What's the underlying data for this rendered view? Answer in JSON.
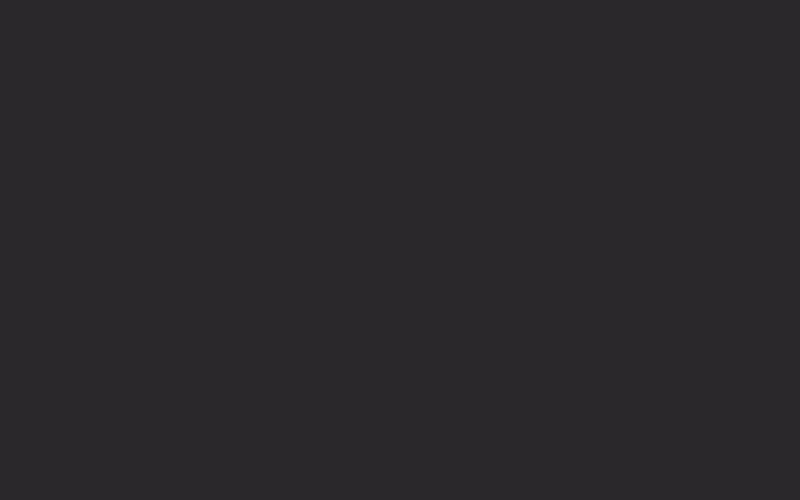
{
  "meta": {
    "type": "architectural-section-drawing",
    "width": 800,
    "height": 500
  },
  "palette": {
    "bg": "#2a282b",
    "bg_dark": "#191719",
    "interior": "#232124",
    "line": "#f4f4f4",
    "line_dim": "#d9d9d9",
    "line_faint": "#b5b5b5",
    "figure": "#f2f2f2",
    "ground": "#59585b",
    "ground_edge": "#6a696c",
    "tree_top": "#343336",
    "tree_mid": "#4b4a4e",
    "tree_light": "#5c5b5f",
    "tree_bottom": "#4a494b",
    "tree_dark": "#2b292c",
    "branch": "#6f6e71"
  },
  "mottle": [
    {
      "cx": 100,
      "cy": 80,
      "r": 130
    },
    {
      "cx": 70,
      "cy": 300,
      "r": 110
    },
    {
      "cx": 420,
      "cy": 240,
      "r": 170
    },
    {
      "cx": 300,
      "cy": 430,
      "r": 140
    },
    {
      "cx": 620,
      "cy": 60,
      "r": 120
    }
  ],
  "ground_block": {
    "x": 0,
    "y": 439,
    "w": 152,
    "h": 61
  },
  "tree": {
    "blobs": [
      {
        "pts": "800,204 760,212 742,198 722,212 698,202 688,222 664,216 676,242 656,250 670,272 650,282 664,302 648,318 662,338 646,354 660,374 648,394 800,398",
        "fill": "tree_mid"
      },
      {
        "pts": "648,388 662,400 650,416 664,432 650,448 662,464 648,480 658,500 800,500 800,384 756,394 724,382 696,398 670,386",
        "fill": "tree_bottom"
      },
      {
        "pts": "726,252 770,240 800,252 800,330 756,344 718,330 700,300 712,272",
        "fill": "tree_light"
      },
      {
        "pts": "664,408 706,396 744,410 752,448 724,478 678,470 654,440",
        "fill": "tree_light"
      },
      {
        "pts": "680,246 700,236 716,252 700,264",
        "fill": "tree_light"
      },
      {
        "pts": "800,30 742,38 716,54 726,72 698,66 706,92 680,90 692,114 670,118 684,142 662,146 676,170 656,172 668,194 652,200 664,220 650,232 800,238",
        "fill": "tree_top"
      },
      {
        "pts": "748,140 800,120 800,200 756,196 736,168",
        "fill": "tree_dark"
      },
      {
        "pts": "690,444 722,436 730,472 700,488",
        "fill": "tree_dark"
      },
      {
        "pts": "660,330 684,318 694,344 668,356",
        "fill": "tree_dark"
      }
    ],
    "branches": [
      [
        712,
        500,
        694,
        386
      ],
      [
        718,
        500,
        734,
        372
      ],
      [
        700,
        474,
        666,
        404
      ],
      [
        742,
        462,
        776,
        384
      ],
      [
        726,
        434,
        758,
        352
      ],
      [
        688,
        500,
        676,
        442
      ],
      [
        734,
        410,
        716,
        348
      ],
      [
        752,
        430,
        792,
        400
      ]
    ]
  },
  "structure": {
    "interior": {
      "x": 152,
      "y": 10,
      "w": 496,
      "h": 447
    },
    "slabs": [
      {
        "x": 146,
        "y": 2,
        "w": 516,
        "h": 11,
        "n": "roof-slab"
      },
      {
        "x": 327,
        "y": 78,
        "w": 335,
        "h": 12,
        "n": "terrace-slab"
      },
      {
        "x": 327,
        "y": 161,
        "w": 335,
        "h": 16,
        "n": "upper-floor-slab-right"
      },
      {
        "x": 148,
        "y": 172,
        "w": 186,
        "h": 12,
        "n": "upper-floor-slab-left"
      },
      {
        "x": 148,
        "y": 267,
        "w": 186,
        "h": 16,
        "n": "mid-floor-slab-left"
      },
      {
        "x": 480,
        "y": 263,
        "w": 182,
        "h": 16,
        "n": "mid-floor-slab-right"
      },
      {
        "x": 480,
        "y": 263,
        "w": 16,
        "h": 37,
        "n": "slab-step"
      },
      {
        "x": 148,
        "y": 345,
        "w": 427,
        "h": 18,
        "n": "lower-floor-slab"
      },
      {
        "x": 148,
        "y": 435,
        "w": 514,
        "h": 20,
        "n": "ground-slab"
      },
      {
        "x": 158,
        "y": 13,
        "w": 14,
        "h": 11,
        "n": "roof-beam-stub"
      },
      {
        "x": 325,
        "y": 13,
        "w": 14,
        "h": 11,
        "n": "roof-beam-stub"
      },
      {
        "x": 472,
        "y": 13,
        "w": 14,
        "h": 11,
        "n": "roof-beam-stub"
      },
      {
        "x": 631,
        "y": 13,
        "w": 12,
        "h": 11,
        "n": "roof-beam-stub"
      },
      {
        "x": 327,
        "y": 90,
        "w": 15,
        "h": 12,
        "n": "beam-stub"
      },
      {
        "x": 483,
        "y": 97,
        "w": 12,
        "h": 9,
        "n": "beam-stub"
      },
      {
        "x": 327,
        "y": 363,
        "w": 14,
        "h": 9,
        "n": "beam-stub"
      },
      {
        "x": 327,
        "y": 455,
        "w": 14,
        "h": 9,
        "n": "beam-stub"
      },
      {
        "x": 472,
        "y": 455,
        "w": 14,
        "h": 9,
        "n": "beam-stub"
      },
      {
        "x": 146,
        "y": 78,
        "w": 12,
        "h": 18,
        "n": "wall-pier"
      },
      {
        "x": 146,
        "y": 166,
        "w": 12,
        "h": 18,
        "n": "wall-pier"
      },
      {
        "x": 146,
        "y": 263,
        "w": 12,
        "h": 20,
        "n": "wall-pier"
      },
      {
        "x": 146,
        "y": 341,
        "w": 12,
        "h": 22,
        "n": "wall-pier"
      },
      {
        "x": 146,
        "y": 428,
        "w": 12,
        "h": 27,
        "n": "wall-pier"
      },
      {
        "x": 151,
        "y": 13,
        "w": 4,
        "h": 444,
        "n": "left-wall"
      },
      {
        "x": 646,
        "y": 8,
        "w": 8,
        "h": 449,
        "n": "right-wall"
      },
      {
        "x": 636,
        "y": 55,
        "w": 10,
        "h": 24,
        "n": "terrace-parapet"
      }
    ],
    "bands": [
      {
        "x": 345,
        "y": 90,
        "w": 293,
        "h": 8
      },
      {
        "x": 348,
        "y": 177,
        "w": 286,
        "h": 8
      },
      {
        "x": 496,
        "y": 279,
        "w": 142,
        "h": 19
      }
    ],
    "walls": [
      [
        328,
        88,
        328,
        435
      ],
      [
        334,
        88,
        334,
        435
      ],
      [
        300,
        150,
        300,
        267
      ],
      [
        255,
        150,
        300,
        150
      ],
      [
        270,
        184,
        270,
        267
      ],
      [
        477,
        184,
        477,
        263
      ],
      [
        481,
        184,
        481,
        263
      ],
      [
        575,
        298,
        575,
        435
      ],
      [
        640,
        103,
        640,
        435
      ]
    ],
    "lines": [
      [
        152,
        26,
        650,
        26
      ],
      [
        157,
        78,
        327,
        78
      ],
      [
        157,
        108,
        327,
        108
      ],
      [
        345,
        103,
        644,
        103
      ],
      [
        152,
        372,
        573,
        372
      ],
      [
        152,
        462,
        648,
        462
      ]
    ],
    "curve": "M158,186 C185,205 235,212 328,213",
    "hatch": [
      [
        165,
        190
      ],
      [
        172,
        194
      ],
      [
        181,
        198
      ],
      [
        196,
        202
      ],
      [
        224,
        206
      ],
      [
        266,
        210
      ]
    ],
    "hatch_end_x": 327,
    "grid": {
      "x1": 336,
      "x2": 477,
      "y1": 263,
      "y2": 344,
      "rows": 11,
      "v_sparse": [
        353,
        371,
        389,
        407
      ],
      "dense_x1": 423,
      "dense_step": 4.5
    },
    "ramp_curves": [
      "M400,344 Q446,341 477,322",
      "M408,344 Q450,343 477,327",
      "M416,344 Q454,345 477,332"
    ],
    "ladder": {
      "x": 255,
      "y": 297,
      "w": 9,
      "h": 48
    }
  },
  "bookshelves": [
    {
      "x": 352,
      "y": 117,
      "w": 110,
      "h": 44,
      "door": {
        "x": 415,
        "w": 22
      },
      "seed": 7
    },
    {
      "x": 500,
      "y": 217,
      "w": 92,
      "h": 45,
      "door": {
        "x": 530,
        "w": 22
      },
      "seed": 13
    }
  ],
  "furniture": [
    {
      "t": "tower",
      "x": 163,
      "y": 215
    },
    {
      "t": "tower",
      "x": 193,
      "y": 215
    },
    {
      "t": "tower",
      "x": 223,
      "y": 215
    },
    {
      "t": "desk",
      "x": 186,
      "y": 250,
      "w": 26
    },
    {
      "t": "desk",
      "x": 216,
      "y": 250,
      "w": 26
    },
    {
      "t": "desk",
      "x": 246,
      "y": 250,
      "w": 26
    },
    {
      "t": "chairL",
      "x": 170,
      "y": 345,
      "w": 18
    },
    {
      "t": "table",
      "x": 198,
      "y": 345,
      "w": 20
    },
    {
      "t": "chairR",
      "x": 224,
      "y": 345,
      "w": 18
    },
    {
      "t": "counter",
      "x": 162,
      "y": 437,
      "w": 63
    },
    {
      "t": "cabinet",
      "x": 162,
      "y": 398
    },
    {
      "t": "rod",
      "x": 189,
      "y": 400
    },
    {
      "t": "chairL",
      "x": 246,
      "y": 435,
      "w": 17
    },
    {
      "t": "table",
      "x": 271,
      "y": 435,
      "w": 21
    },
    {
      "t": "chairR",
      "x": 297,
      "y": 435,
      "w": 18
    },
    {
      "t": "chairL",
      "x": 341,
      "y": 435,
      "w": 18
    },
    {
      "t": "table",
      "x": 369,
      "y": 435,
      "w": 21
    },
    {
      "t": "sidetable",
      "x": 398,
      "y": 435,
      "w": 17
    },
    {
      "t": "xdoor",
      "x": 416,
      "y": 389,
      "w": 37,
      "h": 46
    },
    {
      "t": "box",
      "x": 624,
      "y": 66,
      "w": 14,
      "h": 12
    },
    {
      "t": "box",
      "x": 618,
      "y": 247,
      "w": 18,
      "h": 16
    },
    {
      "t": "box",
      "x": 622,
      "y": 420,
      "w": 15,
      "h": 15
    },
    {
      "t": "xdoor",
      "x": 405,
      "y": 476,
      "w": 38,
      "h": 26
    }
  ],
  "windows": {
    "y": 478,
    "w": 9,
    "h": 24,
    "xs": [
      250,
      288,
      314,
      347,
      374,
      457,
      487,
      518,
      546,
      577,
      606,
      634
    ]
  },
  "tiny_window": {
    "x": 162,
    "y": 482,
    "w": 9,
    "h": 10
  },
  "figures": [
    {
      "p": "walk",
      "x": 403,
      "y": 78
    },
    {
      "p": "child",
      "x": 414,
      "y": 78
    },
    {
      "p": "walk",
      "x": 460,
      "y": 78
    },
    {
      "p": "stand",
      "x": 524,
      "y": 78
    },
    {
      "p": "walk",
      "x": 587,
      "y": 78
    },
    {
      "p": "sit",
      "x": 611,
      "y": 78
    },
    {
      "p": "stand",
      "x": 470,
      "y": 161
    },
    {
      "p": "child",
      "x": 483,
      "y": 161
    },
    {
      "p": "stand",
      "x": 421,
      "y": 160,
      "h": 22
    },
    {
      "p": "stand",
      "x": 429,
      "y": 160,
      "h": 25
    },
    {
      "p": "stand",
      "x": 536,
      "y": 261,
      "h": 22
    },
    {
      "p": "stand",
      "x": 544,
      "y": 261,
      "h": 25
    },
    {
      "p": "sit",
      "x": 604,
      "y": 263
    },
    {
      "p": "sitdesk",
      "x": 178,
      "y": 267
    },
    {
      "p": "sitdesk",
      "x": 208,
      "y": 267
    },
    {
      "p": "sitdesk",
      "x": 238,
      "y": 267
    },
    {
      "p": "stand",
      "x": 294,
      "y": 345
    },
    {
      "p": "sitdesk",
      "x": 200,
      "y": 435
    },
    {
      "p": "stand",
      "x": 532,
      "y": 435
    },
    {
      "p": "child",
      "x": 545,
      "y": 435
    },
    {
      "p": "stand",
      "x": 567,
      "y": 435
    },
    {
      "p": "stand",
      "x": 575,
      "y": 435
    },
    {
      "p": "walk",
      "x": 584,
      "y": 435
    },
    {
      "p": "sit",
      "x": 610,
      "y": 435
    },
    {
      "p": "partial",
      "x": 302,
      "y": 500
    },
    {
      "p": "partial",
      "x": 528,
      "y": 500
    },
    {
      "p": "partial",
      "x": 568,
      "y": 500
    },
    {
      "p": "partial",
      "x": 638,
      "y": 500
    }
  ]
}
